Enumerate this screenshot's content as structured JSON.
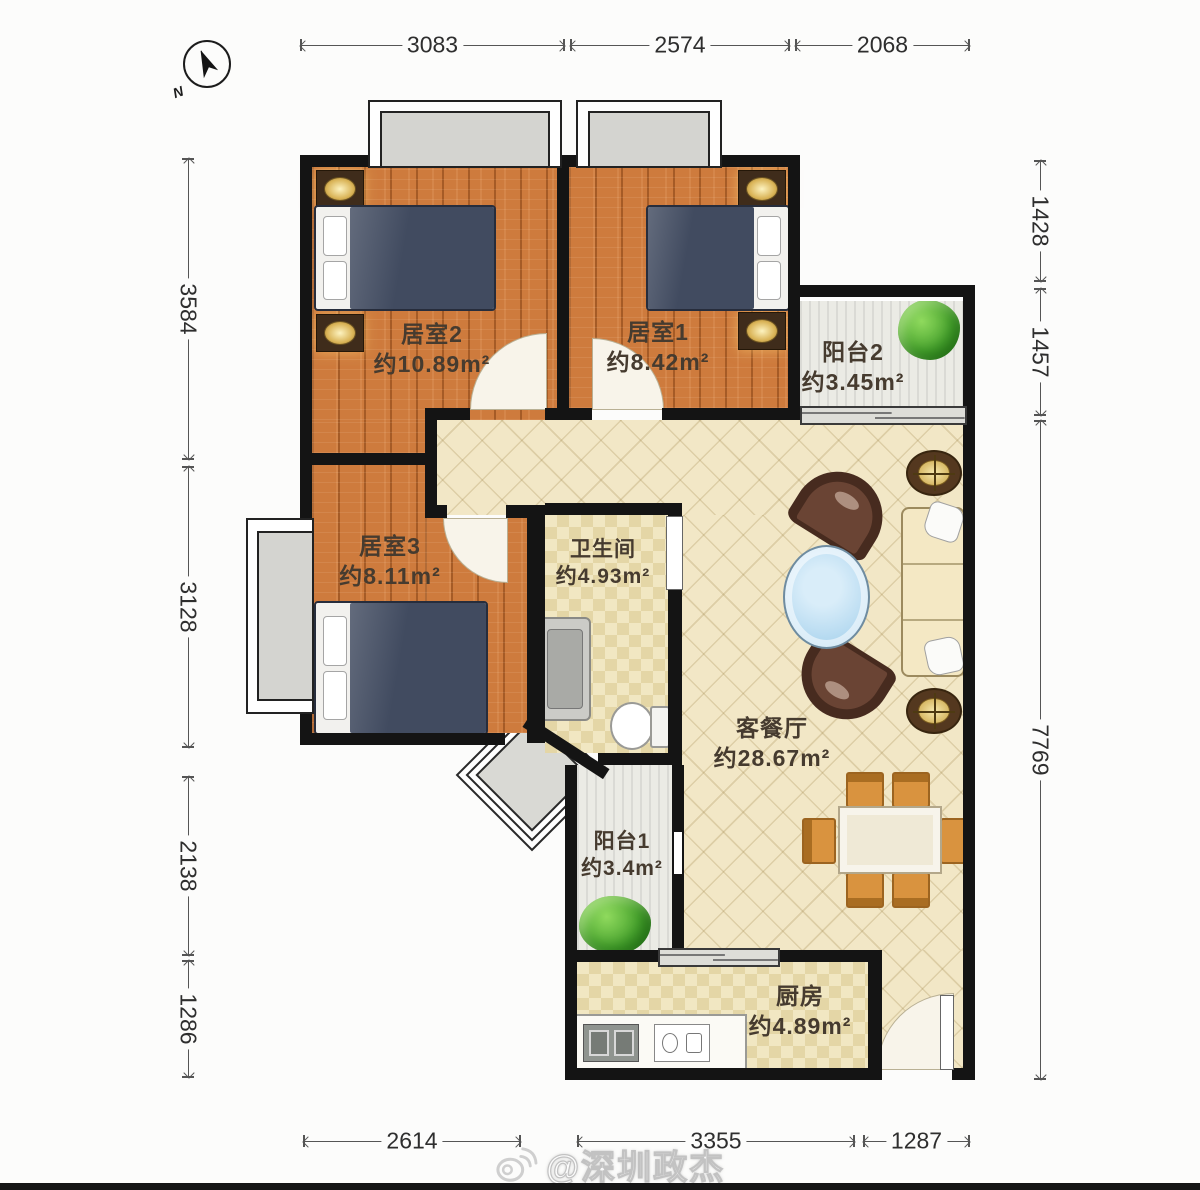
{
  "compass": {
    "north_label": "N"
  },
  "dims": {
    "top": [
      "3083",
      "2574",
      "2068"
    ],
    "left": [
      "3584",
      "3128",
      "2138",
      "1286"
    ],
    "right": [
      "1428",
      "1457",
      "7769"
    ],
    "bottom": [
      "2614",
      "3355",
      "1287"
    ]
  },
  "rooms": {
    "bedroom2": {
      "name": "居室2",
      "area": "约10.89m²"
    },
    "bedroom1": {
      "name": "居室1",
      "area": "约8.42m²"
    },
    "balcony2": {
      "name": "阳台2",
      "area": "约3.45m²"
    },
    "bedroom3": {
      "name": "居室3",
      "area": "约8.11m²"
    },
    "bathroom": {
      "name": "卫生间",
      "area": "约4.93m²"
    },
    "living_dining": {
      "name": "客餐厅",
      "area": "约28.67m²"
    },
    "balcony1": {
      "name": "阳台1",
      "area": "约3.4m²"
    },
    "kitchen": {
      "name": "厨房",
      "area": "约4.89m²"
    }
  },
  "watermark": {
    "handle": "@深圳政杰"
  },
  "colors": {
    "wall": "#141414",
    "wood_floor": "#ce7b3d",
    "tile_floor": "#f2e7c6",
    "balcony_floor": "#ebebe5",
    "chair_wood": "#d9933f",
    "table_glass_blue": "#b4d9f0",
    "plant_green": "#4aa52f",
    "bed_navy": "#414b60"
  }
}
